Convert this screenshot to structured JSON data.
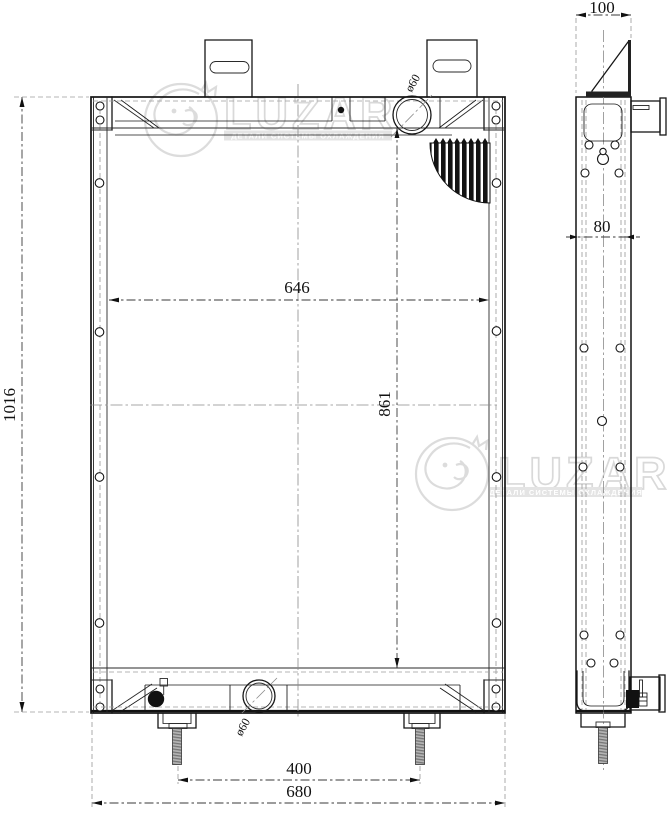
{
  "drawing": {
    "front_view": {
      "dim_overall_height": "1016",
      "dim_core_width": "646",
      "dim_core_height": "861",
      "dim_stud_spacing": "400",
      "dim_overall_width": "680",
      "label_top_neck": "ø60",
      "label_bottom_neck": "ø60"
    },
    "side_view": {
      "dim_depth": "100",
      "dim_hole_spacing": "80"
    },
    "watermark": {
      "brand": "LUZAR",
      "tagline": "ДЕТАЛИ СИСТЕМЫ ОХЛАЖДЕНИЯ"
    }
  }
}
